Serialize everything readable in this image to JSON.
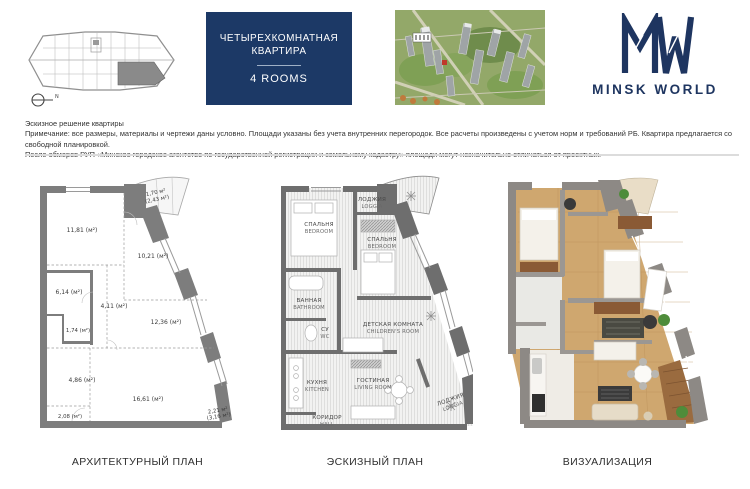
{
  "colors": {
    "navy": "#1c3966",
    "logo_navy": "#1e3560",
    "wall_gray": "#7d7d7d",
    "sketch_wall_gray": "#6e6e6e",
    "wood": "#cfa76f",
    "marker_red": "#c0392b",
    "divider": "#dcdcdc"
  },
  "header": {
    "unit_locator": {
      "compass_label": "N"
    },
    "title_card": {
      "line1": "ЧЕТЫРЕХКОМНАТНАЯ",
      "line2": "КВАРТИРА",
      "subtitle": "4 ROOMS"
    },
    "logo": {
      "brand": "MINSK WORLD"
    }
  },
  "disclaimer": {
    "line1": "Эскизное решение квартиры",
    "line2": "Примечание: все размеры, материалы и чертежи даны условно. Площади указаны без учета внутренних перегородок. Все расчеты произведены с учетом норм и требований РБ. Квартира предлагается со свободной планировкой.",
    "line3": "После обмеров РУП «Минское городское агентство по государственной регистрации и земельному кадастру» площади могут незначительно отличаться от проектных."
  },
  "plans": {
    "architectural": {
      "caption": "АРХИТЕКТУРНЫЙ ПЛАН",
      "areas": [
        {
          "label": "1,70 м²",
          "label2": "(2,43 м²)"
        },
        {
          "label": "11,81 (м²)"
        },
        {
          "label": "10,21 (м²)"
        },
        {
          "label": "6,14 (м²)"
        },
        {
          "label": "4,11 (м²)"
        },
        {
          "label": "12,36 (м²)"
        },
        {
          "label": "1,74 (м²)"
        },
        {
          "label": "4,86 (м²)"
        },
        {
          "label": "16,61 (м²)"
        },
        {
          "label": "2,08 (м²)"
        },
        {
          "label": "2,21 м²",
          "label2": "(3,16 м²)"
        }
      ]
    },
    "sketch": {
      "caption": "ЭСКИЗНЫЙ ПЛАН",
      "rooms": [
        {
          "ru": "ЛОДЖИЯ",
          "en": "LOGGIA"
        },
        {
          "ru": "СПАЛЬНЯ",
          "en": "BEDROOM"
        },
        {
          "ru": "СПАЛЬНЯ",
          "en": "BEDROOM"
        },
        {
          "ru": "ВАННАЯ",
          "en": "BATHROOM"
        },
        {
          "ru": "СУ",
          "en": "WC"
        },
        {
          "ru": "ДЕТСКАЯ КОМНАТА",
          "en": "CHILDREN'S ROOM"
        },
        {
          "ru": "КУХНЯ",
          "en": "KITCHEN"
        },
        {
          "ru": "ГОСТИНАЯ",
          "en": "LIVING ROOM"
        },
        {
          "ru": "КОРИДОР",
          "en": "HALL"
        },
        {
          "ru": "ЛОДЖИЯ",
          "en": "LOGGIA"
        }
      ]
    },
    "visualization": {
      "caption": "ВИЗУАЛИЗАЦИЯ"
    }
  }
}
